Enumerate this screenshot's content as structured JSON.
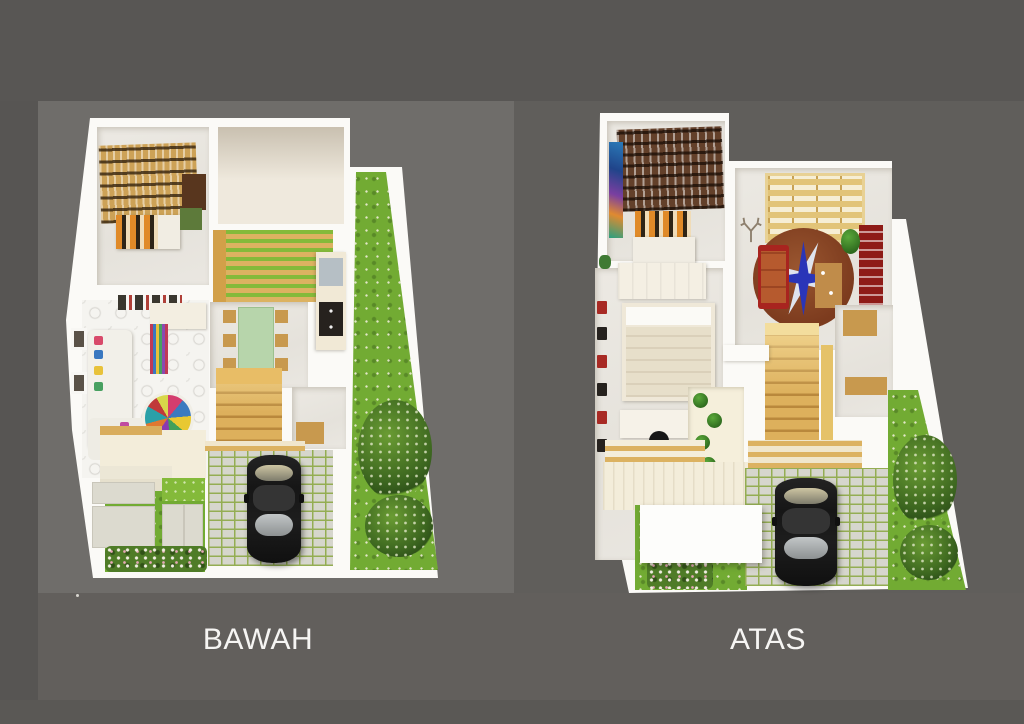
{
  "scene": {
    "description": "Two 3D-rendered house floor plans shown side by side on a gray backdrop",
    "panel_count": 2
  },
  "plans": [
    {
      "label": "BAWAH",
      "floor": "lower floor",
      "rooms": [
        "bedroom with bookshelf, desk and bed",
        "open room",
        "inner court with wood pergola over grass",
        "dining room with green table and wood chairs",
        "kitchen with sink and stove",
        "bathroom",
        "wood staircase",
        "living room with white sofa, striped curtain and multicolor round rug",
        "front porch with pergola",
        "front yard with stepping stones and flower bed",
        "carport with black car on paving blocks",
        "side garden with shrubs"
      ]
    },
    {
      "label": "ATAS",
      "floor": "upper floor",
      "rooms": [
        "library room with dark wood shelves, wall painting and bed",
        "bedroom with wardrobe, bed and desk with office chair",
        "family room with round compass rug, red sofa, wood desk, red shelf and skylight pergola",
        "stairwell with lit wood stairs",
        "planter court with green pot plants",
        "hallway with wood cabinets",
        "balcony with wood slats",
        "white porch roof",
        "carport with black car on paving blocks",
        "front yard with stepping stones and flower bed",
        "side garden with shrubs"
      ]
    }
  ],
  "palette": {
    "page_bg": "#625F5C",
    "top_band": "#585654",
    "left_panel_bg": "#6F6D6A",
    "right_panel_bg": "#605E5B",
    "platform_white": "#FBFAF7",
    "grass_green": "#72AB33",
    "wood_light": "#DDB05C",
    "wood_dark": "#63402A",
    "stair_wood": "#D9A94F",
    "rug_brown": "#7C3B1E",
    "compass_blue": "#2A35B8",
    "sofa_red": "#A8241F",
    "car_black": "#1F1F1F",
    "paving_gray": "#D6D6CD",
    "dining_table_green": "#B7D5AB",
    "label_text": "#F6F5F3"
  }
}
